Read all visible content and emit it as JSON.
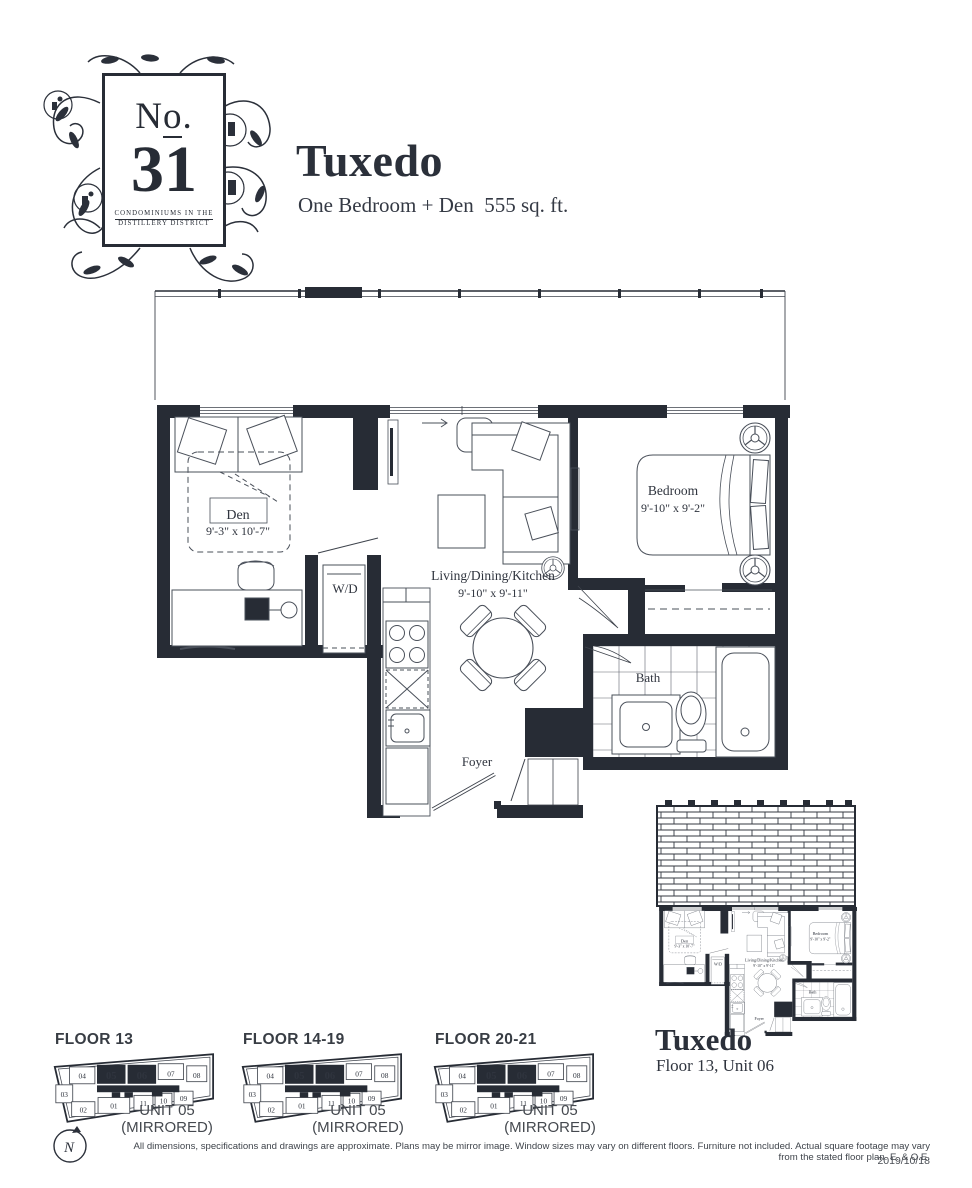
{
  "palette": {
    "ink": "#272c35",
    "label": "#2f343e",
    "muted": "#45494f",
    "background": "#ffffff"
  },
  "logo": {
    "prefix_n": "N",
    "prefix_o": "o",
    "prefix_dot": ".",
    "number": "31",
    "tagline1": "CONDOMINIUMS IN THE",
    "tagline2": "DISTILLERY DISTRICT"
  },
  "header": {
    "title": "Tuxedo",
    "subtitle": "One Bedroom + Den  555 sq. ft."
  },
  "main_plan": {
    "rooms": [
      {
        "name": "Den",
        "dims": "9'-3\" x 10'-7\""
      },
      {
        "name": "W/D",
        "dims": ""
      },
      {
        "name": "Living/Dining/Kitchen",
        "dims": "9'-10\" x 9'-11\""
      },
      {
        "name": "Bedroom",
        "dims": "9'-10\" x 9'-2\""
      },
      {
        "name": "Bath",
        "dims": ""
      },
      {
        "name": "Foyer",
        "dims": ""
      }
    ]
  },
  "mini_plan": {
    "title": "Tuxedo",
    "subtitle": "Floor 13, Unit 06"
  },
  "key_plans": {
    "units_row1": [
      "04",
      "05",
      "06",
      "07",
      "08"
    ],
    "units_row2": [
      "03",
      "02",
      "01",
      "11",
      "10",
      "09"
    ],
    "highlighted_units": [
      "05",
      "06"
    ],
    "plans": [
      {
        "label": "FLOOR 13",
        "unit_label": "UNIT 05",
        "unit_sublabel": "(MIRRORED)"
      },
      {
        "label": "FLOOR 14-19",
        "unit_label": "UNIT 05",
        "unit_sublabel": "(MIRRORED)"
      },
      {
        "label": "FLOOR 20-21",
        "unit_label": "UNIT 05",
        "unit_sublabel": "(MIRRORED)"
      }
    ]
  },
  "compass": {
    "label": "N"
  },
  "footer": {
    "disclaimer": "All dimensions, specifications and drawings are approximate. Plans may be mirror image. Window sizes may vary on different floors. Furniture not included. Actual square footage may vary from the stated floor plan. E. & O.E.",
    "date": "2019/10/18"
  }
}
